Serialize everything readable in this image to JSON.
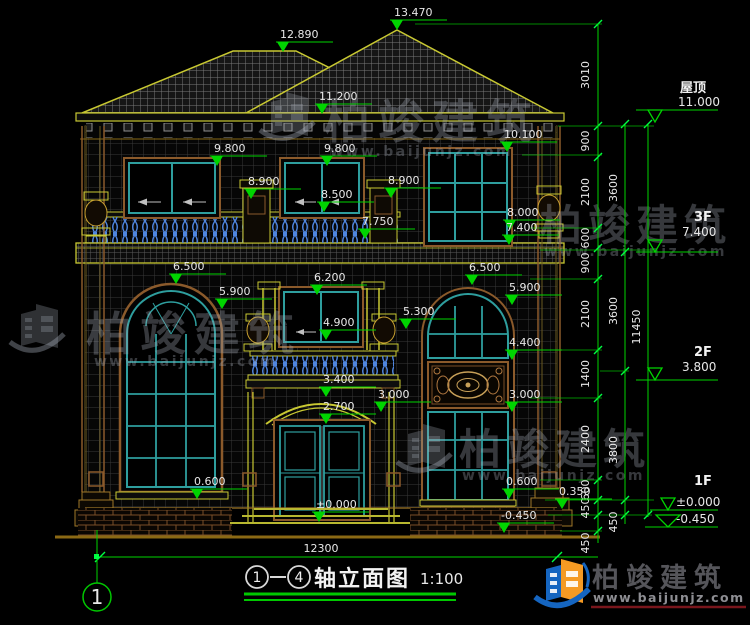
{
  "drawing": {
    "axis_from": "1",
    "axis_to": "4",
    "title": "轴立面图",
    "scale": "1:100",
    "axis_bubble": "1",
    "total_width": "12300"
  },
  "markers": [
    "12.890",
    "13.470",
    "11.200",
    "9.800",
    "9.800",
    "10.100",
    "8.900",
    "8.900",
    "8.500",
    "8.000",
    "7.400",
    "7.750",
    "6.500",
    "6.200",
    "6.500",
    "5.900",
    "5.900",
    "4.900",
    "5.300",
    "4.400",
    "3.400",
    "3.000",
    "3.000",
    "2.700",
    "0.600",
    "0.600",
    "0.350",
    "-0.450",
    "±0.000"
  ],
  "levels": [
    {
      "name": "屋顶",
      "value": "11.000"
    },
    {
      "name": "3F",
      "value": "7.400"
    },
    {
      "name": "2F",
      "value": "3.800"
    },
    {
      "name": "1F",
      "value": "±0.000"
    },
    {
      "name": "",
      "value": "-0.450"
    }
  ],
  "dims": {
    "chain_inner": [
      "3010",
      "900",
      "2100",
      "600",
      "900",
      "2100",
      "1400",
      "2400",
      "600",
      "450",
      "450"
    ],
    "chain_mid": [
      "3600",
      "3600",
      "3800",
      "450"
    ],
    "chain_outer": [
      "11450"
    ]
  },
  "watermark": {
    "brand": "柏竣建筑",
    "url": "www.baijunjz.com"
  },
  "footer_logo": {
    "brand": "柏竣建筑",
    "url": "www.baijunjz.com"
  },
  "colors": {
    "dim_green": "#00d400",
    "cad_yellow": "#c8c832",
    "wood_brown": "#8b5a2b",
    "window_teal": "#2e9e9e",
    "baluster_blue": "#4f86e0",
    "logo_blue": "#1565c0",
    "logo_orange": "#f59a23"
  }
}
